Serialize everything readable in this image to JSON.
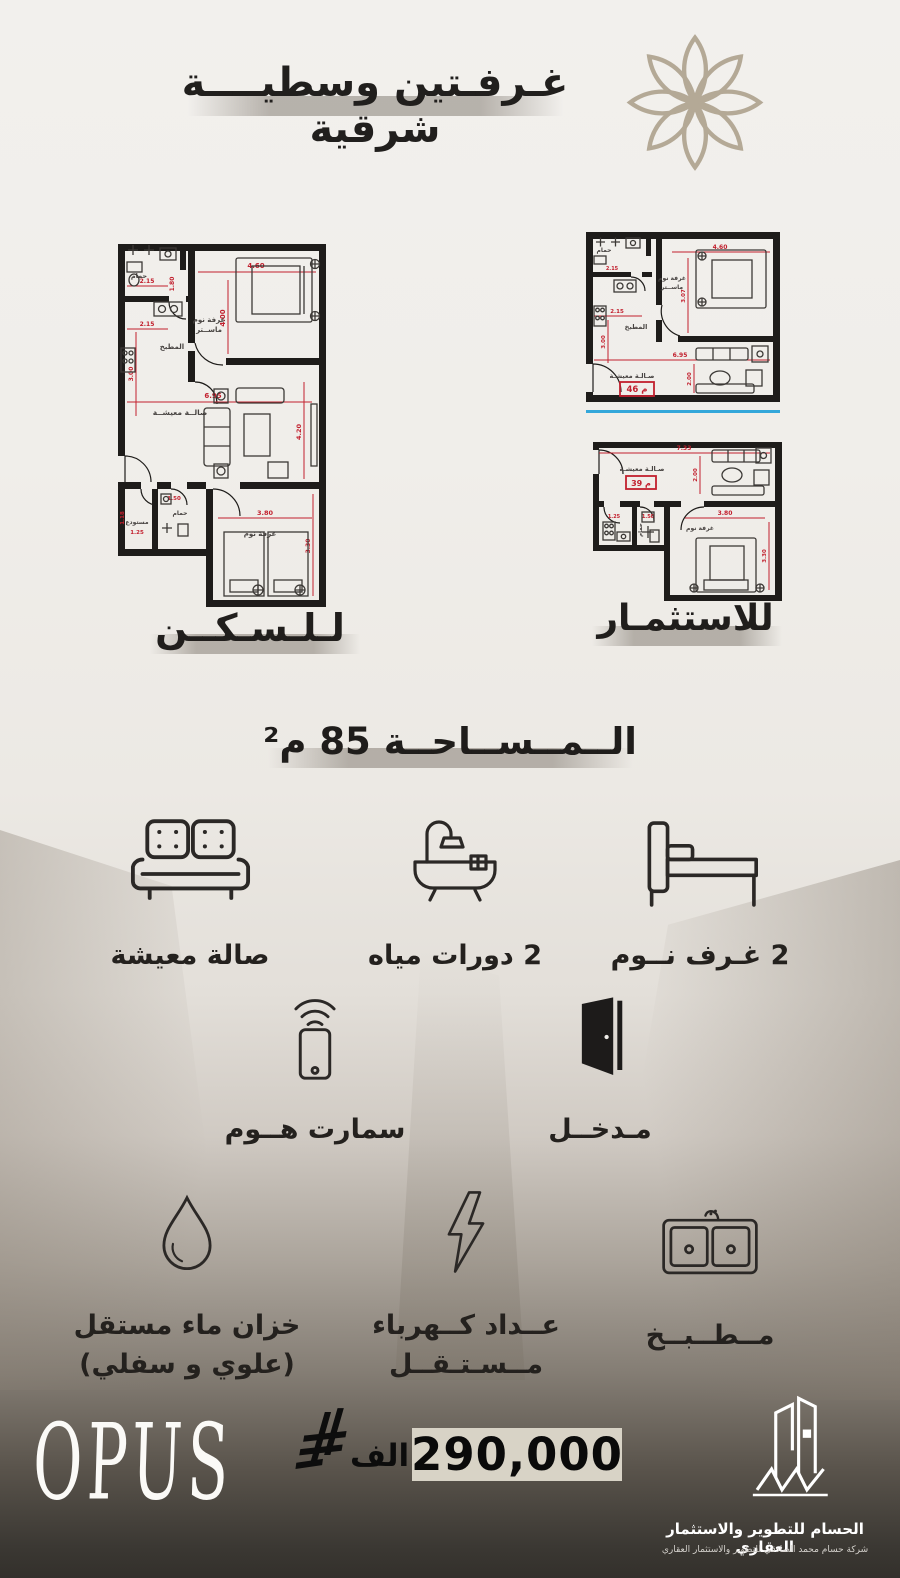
{
  "header": {
    "title": "غـرفـتين وسطيــــة شرقية"
  },
  "plans": {
    "right_label": "للاستثمـار",
    "left": {
      "label": "لـلـسـكــن",
      "rooms": {
        "bath": "حمام",
        "kitchen": "المطبخ",
        "master1": "غرفة نوم",
        "master2": "ماســتر",
        "living": "صالــة معيشــة",
        "storage": "مستودع",
        "bath2": "حمام",
        "bedroom": "غرفة نوم"
      },
      "dims": {
        "top": "4.60",
        "master_h": "4.00",
        "bath_w": "2.15",
        "bath_h": "1.80",
        "kitchen_w": "2.15",
        "kitchen_h": "3.00",
        "living_w": "6.95",
        "living_h": "4.20",
        "storage_w": "1.25",
        "storage_h": "1.18",
        "bath2_w": "1.50",
        "bed_w": "3.80",
        "bed_h": "3.30"
      }
    },
    "upper": {
      "badge": "46 م",
      "rooms": {
        "bath": "حمام",
        "kitchen": "المطبخ",
        "master1": "غرفة نوم",
        "master2": "ماســتر",
        "living": "صـالـة معيشـة"
      },
      "dims": {
        "top": "4.60",
        "bath_w": "2.15",
        "kitchen_w": "2.15",
        "kitchen_h": "3.00",
        "master_h": "3.07",
        "living_w": "6.95",
        "living_h": "2.00"
      }
    },
    "lower": {
      "badge": "39 م",
      "rooms": {
        "living": "صـالـة معيشـة",
        "bath": "حمام",
        "bedroom": "غرفة نوم"
      },
      "dims": {
        "top": "7.33",
        "living_h": "2.00",
        "kitchen_w": "1.25",
        "bath_w": "1.50",
        "bed_w": "3.80",
        "bed_h": "3.30"
      }
    }
  },
  "area": {
    "text": "الــمــســاحــة 85 م²"
  },
  "features": {
    "living": {
      "label": "صالة معيشة"
    },
    "baths": {
      "label": "2 دورات مياه"
    },
    "bedrooms": {
      "label": "2 غـرف نــوم"
    },
    "smart": {
      "label": "سمارت هــوم"
    },
    "entrance": {
      "label": "مـدخــل"
    },
    "water": {
      "label": "خزان ماء مستقل",
      "label2": "(علوي و سفلي)"
    },
    "meter": {
      "label": "عــداد كــهرباء",
      "label2": "مــسـتـقــل"
    },
    "kitchen": {
      "label": "مــطــبــخ"
    }
  },
  "footer": {
    "brand": "OPUS",
    "price": "290,000",
    "unit": "الف",
    "company": "الحسام للتطوير والاستثمار العقاري",
    "company_sub": "شركة حسام محمد الصادقي للتطوير والاستثمار العقاري"
  },
  "colors": {
    "accent_red": "#c2202e",
    "flower": "#b4a996",
    "blue_line": "#34a7da"
  }
}
